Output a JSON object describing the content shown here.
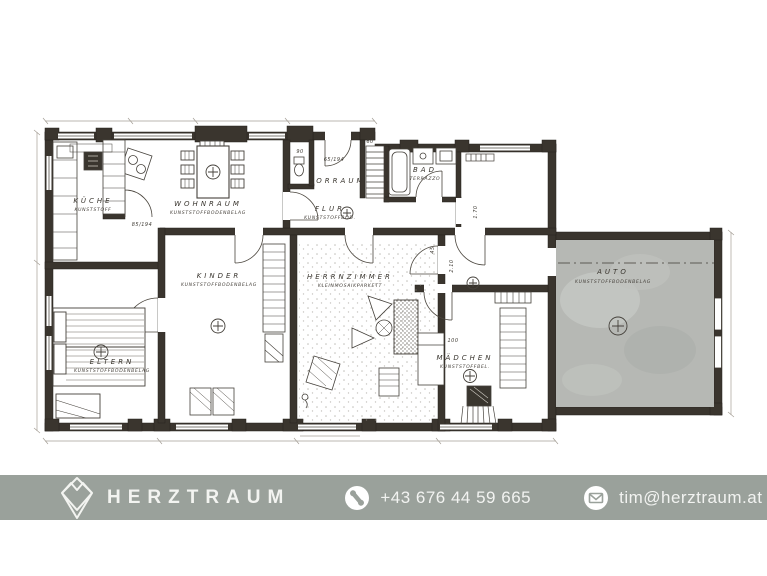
{
  "floorplan": {
    "rooms": [
      {
        "id": "kueche",
        "name": "KÜCHE",
        "material": "KUNSTSTOFF"
      },
      {
        "id": "wohnraum",
        "name": "WOHNRAUM",
        "material": "KUNSTSTOFFBODENBELAG"
      },
      {
        "id": "vorraum",
        "name": "VORRAUM",
        "material": ""
      },
      {
        "id": "bad",
        "name": "BAD",
        "material": "TERRAZZO"
      },
      {
        "id": "flur",
        "name": "FLUR",
        "material": "KUNSTSTOFFBOD."
      },
      {
        "id": "kinder",
        "name": "KINDER",
        "material": "KUNSTSTOFFBODENBELAG"
      },
      {
        "id": "eltern",
        "name": "ELTERN",
        "material": "KUNSTSTOFFBODENBELAG"
      },
      {
        "id": "herrnzimmer",
        "name": "HERRNZIMMER",
        "material": "KLEINMOSAIKPARKETT"
      },
      {
        "id": "maedchen",
        "name": "MÄDCHEN",
        "material": "KUNSTSTOFFBEL."
      },
      {
        "id": "auto",
        "name": "AUTO",
        "material": "KUNSTSTOFFBODENBELAG"
      }
    ],
    "dimensions": {
      "wc_width": "90",
      "stair_width": "60",
      "flur_height": "45",
      "maedchen_width": "100",
      "room_height": "1.70",
      "corridor_height": "2.10",
      "door_kueche": "85/194",
      "door_vorraum": "65/194"
    },
    "colors": {
      "wall": "#3a352e",
      "line": "#4b463e",
      "garage_floor": "#b6b8b4"
    }
  },
  "footer": {
    "brand": "HERZTRAUM",
    "phone": "+43 676 44 59 665",
    "email": "tim@herztraum.at",
    "colors": {
      "bar": "#9aa19b",
      "text": "#f3f4f1"
    }
  }
}
